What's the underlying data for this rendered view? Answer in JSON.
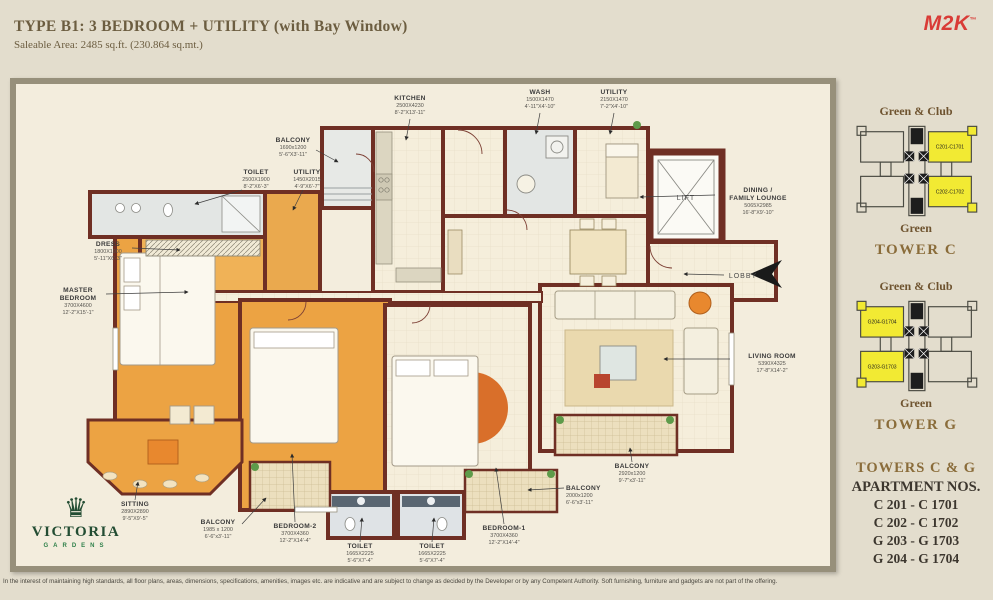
{
  "header": {
    "title": "TYPE B1: 3 BEDROOM + UTILITY (with Bay Window)",
    "subtitle": "Saleable Area: 2485 sq.ft. (230.864 sq.mt.)",
    "brand": "M2K",
    "brand_tm": "™"
  },
  "plan": {
    "rooms": [
      {
        "name": "BALCONY",
        "mm": "1690x1200",
        "ft": "5'-6\"X3'-11\""
      },
      {
        "name": "KITCHEN",
        "mm": "2500X4230",
        "ft": "8'-2\"X13'-11\""
      },
      {
        "name": "WASH",
        "mm": "1500X1470",
        "ft": "4'-11\"X4'-10\""
      },
      {
        "name": "UTILITY",
        "mm": "2150X1470",
        "ft": "7'-2\"X4'-10\""
      },
      {
        "name": "TOILET",
        "mm": "2500X1900",
        "ft": "8'-2\"X6'-3\""
      },
      {
        "name": "UTILITY",
        "mm": "1450X2015",
        "ft": "4'-9\"X6'-7\""
      },
      {
        "name": "DRESS",
        "mm": "1800X1900",
        "ft": "5'-11\"X6'-3\""
      },
      {
        "name": "MASTER",
        "name2": "BEDROOM",
        "mm": "3700X4600",
        "ft": "12'-2\"X15'-1\""
      },
      {
        "name": "DINING /",
        "name2": "FAMILY LOUNGE",
        "mm": "5065X2985",
        "ft": "16'-8\"X9'-10\""
      },
      {
        "name": "LIVING ROOM",
        "mm": "5390X4325",
        "ft": "17'-8\"X14'-2\""
      },
      {
        "name": "SITTING",
        "mm": "2890X2890",
        "ft": "9'-5\"X9'-5\""
      },
      {
        "name": "BALCONY",
        "mm": "1985 x 1200",
        "ft": "6'-6\"x3'-11\""
      },
      {
        "name": "BEDROOM-2",
        "mm": "3700X4360",
        "ft": "12'-2\"X14'-4\""
      },
      {
        "name": "TOILET",
        "mm": "1665X2225",
        "ft": "5'-6\"X7'-4\""
      },
      {
        "name": "TOILET",
        "mm": "1665X2225",
        "ft": "5'-6\"X7'-4\""
      },
      {
        "name": "BEDROOM-1",
        "mm": "3700X4360",
        "ft": "12'-2\"X14'-4\""
      },
      {
        "name": "BALCONY",
        "mm": "2000x1200",
        "ft": "6'-6\"x3'-11\""
      },
      {
        "name": "BALCONY",
        "mm": "2920x1200",
        "ft": "9'-7\"x3'-11\""
      }
    ],
    "lift": "LIFT",
    "lobby": "LOBBY"
  },
  "sidebar": {
    "tower_c": {
      "top": "Green & Club",
      "bottom": "Green",
      "title": "TOWER C",
      "unit_top": "C201-C1701",
      "unit_bottom": "C202-C1702"
    },
    "tower_g": {
      "top": "Green & Club",
      "bottom": "Green",
      "title": "TOWER G",
      "unit_top": "G204-G1704",
      "unit_bottom": "G203-G1703"
    },
    "apartments": {
      "title": "TOWERS C & G",
      "subtitle": "APARTMENT NOS.",
      "list": [
        "C 201 - C 1701",
        "C 202 - C 1702",
        "G 203 - G 1703",
        "G 204 - G 1704"
      ]
    }
  },
  "logo": {
    "crown": "♛",
    "name": "VICTORIA",
    "sub": "GARDENS"
  },
  "footer": {
    "disclaimer": "In the interest of maintaining high standards, all floor plans, areas, dimensions, specifications, amenities, images etc. are indicative and are subject to change as decided by the Developer or by any Competent Authority. Soft furnishing, furniture and gadgets are not part of the offering."
  },
  "colors": {
    "wall": "#6f2f24",
    "room_orange": "#eca343",
    "highlight_yellow": "#f2ea33",
    "brand_red": "#d93b36",
    "brand_brown": "#8a6c3a",
    "logo_green": "#234d33"
  }
}
